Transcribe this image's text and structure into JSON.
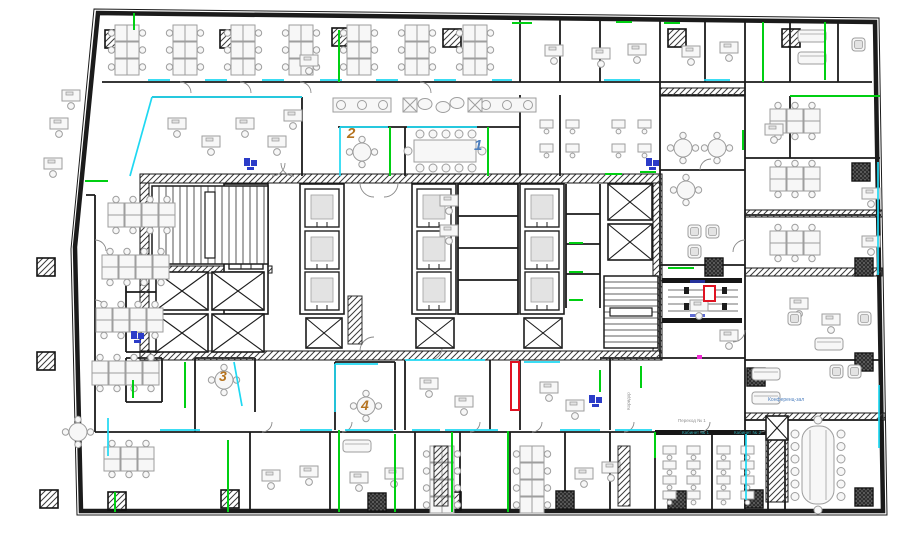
{
  "labels": {
    "room1": "1",
    "room2": "2",
    "room3": "3",
    "room4": "4",
    "conference": "Конференц-зал",
    "cabinet1": "Кабинет № 1",
    "cabinet2": "Кабинет № 2",
    "walkway": "Переход № 1",
    "corridor": "Коридор"
  },
  "colors": {
    "wall": "#1b1b1b",
    "fur": "#9e9e9e",
    "accent_cyan": "#1fd8f2",
    "accent_green": "#00cf12",
    "accent_red": "#e01322",
    "accent_blue": "#2b3cc8",
    "accent_magenta": "#f02bd4",
    "label_orange": "#b5731f",
    "label_blue": "#4d7fbe",
    "label_teal": "#2fa0a8",
    "label_gray": "#8f8f8f"
  },
  "overlays": {
    "cyan_segments": [
      [
        148,
        80,
        170,
        80
      ],
      [
        205,
        80,
        227,
        80
      ],
      [
        262,
        80,
        284,
        80
      ],
      [
        320,
        80,
        342,
        80
      ],
      [
        376,
        80,
        398,
        80
      ],
      [
        434,
        80,
        456,
        80
      ],
      [
        492,
        80,
        512,
        80
      ],
      [
        604,
        80,
        640,
        80
      ],
      [
        704,
        80,
        730,
        80
      ],
      [
        152,
        97,
        302,
        97
      ],
      [
        152,
        97,
        130,
        176
      ],
      [
        340,
        127,
        388,
        127
      ],
      [
        407,
        127,
        477,
        127
      ],
      [
        340,
        127,
        340,
        176
      ],
      [
        234,
        362,
        242,
        406
      ],
      [
        335,
        364,
        378,
        364
      ],
      [
        335,
        364,
        335,
        412
      ],
      [
        108,
        418,
        108,
        456
      ],
      [
        160,
        430,
        200,
        430
      ],
      [
        300,
        430,
        332,
        430
      ],
      [
        345,
        430,
        393,
        430
      ],
      [
        412,
        430,
        440,
        430
      ],
      [
        445,
        430,
        498,
        430
      ],
      [
        560,
        430,
        600,
        430
      ],
      [
        615,
        430,
        652,
        430
      ],
      [
        878,
        162,
        878,
        275
      ],
      [
        879,
        385,
        879,
        448
      ],
      [
        746,
        434,
        746,
        500
      ],
      [
        405,
        360,
        485,
        360
      ],
      [
        524,
        362,
        560,
        362
      ]
    ],
    "green_segments": [
      [
        134,
        13,
        134,
        30
      ],
      [
        339,
        30,
        339,
        82
      ],
      [
        512,
        23,
        532,
        23
      ],
      [
        616,
        22,
        632,
        22
      ],
      [
        664,
        23,
        680,
        23
      ],
      [
        763,
        22,
        763,
        82
      ],
      [
        825,
        22,
        825,
        80
      ],
      [
        790,
        96,
        880,
        96
      ],
      [
        743,
        130,
        743,
        150
      ],
      [
        85,
        181,
        108,
        181
      ],
      [
        390,
        127,
        390,
        176
      ],
      [
        488,
        127,
        488,
        176
      ],
      [
        605,
        174,
        622,
        174
      ],
      [
        640,
        172,
        656,
        172
      ],
      [
        569,
        243,
        583,
        243
      ],
      [
        569,
        272,
        583,
        272
      ],
      [
        569,
        300,
        583,
        300
      ],
      [
        668,
        268,
        694,
        268
      ],
      [
        641,
        366,
        641,
        388
      ],
      [
        600,
        370,
        600,
        392
      ],
      [
        133,
        380,
        133,
        398
      ],
      [
        185,
        362,
        185,
        408
      ],
      [
        339,
        430,
        339,
        512
      ],
      [
        395,
        434,
        395,
        512
      ],
      [
        452,
        432,
        452,
        512
      ],
      [
        508,
        431,
        508,
        512
      ],
      [
        228,
        440,
        228,
        512
      ],
      [
        115,
        492,
        115,
        512
      ],
      [
        655,
        432,
        655,
        458
      ]
    ],
    "red_gate_box": [
      704,
      286,
      11,
      15
    ],
    "red_wall_segment": [
      511,
      362,
      8,
      48
    ],
    "magenta_dot": [
      697,
      355,
      5,
      4
    ],
    "blue_equipment": [
      [
        244,
        158
      ],
      [
        646,
        158
      ],
      [
        131,
        331
      ],
      [
        589,
        395
      ]
    ]
  },
  "furniture": {
    "columns_hatched": [
      [
        105,
        30
      ],
      [
        220,
        30
      ],
      [
        332,
        28
      ],
      [
        443,
        29
      ],
      [
        668,
        29
      ],
      [
        782,
        29
      ],
      [
        37,
        258
      ],
      [
        37,
        352
      ],
      [
        40,
        490
      ],
      [
        108,
        492
      ],
      [
        221,
        490
      ],
      [
        443,
        492
      ]
    ],
    "columns_dark": [
      [
        368,
        493
      ],
      [
        556,
        491
      ],
      [
        668,
        491
      ],
      [
        855,
        488
      ],
      [
        852,
        163
      ],
      [
        855,
        258
      ],
      [
        705,
        258
      ],
      [
        855,
        353
      ],
      [
        747,
        368
      ],
      [
        745,
        490
      ]
    ],
    "bench_clusters_v": [
      {
        "x": 110,
        "y": 25,
        "rows": 3
      },
      {
        "x": 168,
        "y": 25,
        "rows": 3
      },
      {
        "x": 226,
        "y": 25,
        "rows": 3
      },
      {
        "x": 284,
        "y": 25,
        "rows": 3
      },
      {
        "x": 342,
        "y": 25,
        "rows": 3
      },
      {
        "x": 400,
        "y": 25,
        "rows": 3
      },
      {
        "x": 458,
        "y": 25,
        "rows": 3
      },
      {
        "x": 425,
        "y": 446,
        "rows": 4
      },
      {
        "x": 515,
        "y": 446,
        "rows": 4
      }
    ],
    "bench_rows_h": [
      {
        "x": 108,
        "y": 198,
        "cols": 4
      },
      {
        "x": 102,
        "y": 250,
        "cols": 4
      },
      {
        "x": 96,
        "y": 303,
        "cols": 4
      },
      {
        "x": 92,
        "y": 356,
        "cols": 4
      },
      {
        "x": 104,
        "y": 442,
        "cols": 3
      },
      {
        "x": 770,
        "y": 104,
        "cols": 3
      },
      {
        "x": 770,
        "y": 162,
        "cols": 3
      },
      {
        "x": 770,
        "y": 226,
        "cols": 3
      }
    ],
    "desk_grids": [
      {
        "x": 663,
        "y": 446,
        "rows": 4,
        "cols": 2,
        "dx": 24,
        "dy": 15
      },
      {
        "x": 717,
        "y": 446,
        "rows": 4,
        "cols": 2,
        "dx": 24,
        "dy": 15
      },
      {
        "x": 540,
        "y": 120,
        "rows": 2,
        "cols": 2,
        "dx": 26,
        "dy": 24
      },
      {
        "x": 612,
        "y": 120,
        "rows": 2,
        "cols": 2,
        "dx": 26,
        "dy": 24
      }
    ],
    "single_desks": [
      [
        50,
        118
      ],
      [
        44,
        158
      ],
      [
        62,
        90
      ],
      [
        300,
        55
      ],
      [
        545,
        45
      ],
      [
        592,
        48
      ],
      [
        628,
        44
      ],
      [
        682,
        46
      ],
      [
        720,
        42
      ],
      [
        168,
        118
      ],
      [
        202,
        136
      ],
      [
        236,
        118
      ],
      [
        268,
        136
      ],
      [
        284,
        110
      ],
      [
        440,
        195
      ],
      [
        440,
        225
      ],
      [
        690,
        300
      ],
      [
        720,
        330
      ],
      [
        262,
        470
      ],
      [
        300,
        466
      ],
      [
        350,
        472
      ],
      [
        385,
        468
      ],
      [
        575,
        468
      ],
      [
        602,
        462
      ],
      [
        420,
        378
      ],
      [
        455,
        396
      ],
      [
        540,
        382
      ],
      [
        566,
        400
      ],
      [
        790,
        298
      ],
      [
        822,
        314
      ],
      [
        765,
        124
      ],
      [
        862,
        188
      ],
      [
        862,
        236
      ]
    ],
    "round_tables": [
      [
        362,
        152
      ],
      [
        224,
        380
      ],
      [
        366,
        406
      ],
      [
        683,
        148
      ],
      [
        717,
        148
      ],
      [
        686,
        190
      ],
      [
        78,
        432
      ]
    ],
    "sofas": [
      [
        798,
        30
      ],
      [
        798,
        52
      ],
      [
        752,
        368
      ],
      [
        752,
        392
      ],
      [
        815,
        338
      ],
      [
        343,
        440
      ]
    ],
    "armchairs": [
      [
        852,
        38
      ],
      [
        830,
        365
      ],
      [
        848,
        365
      ],
      [
        788,
        312
      ],
      [
        858,
        312
      ],
      [
        688,
        225
      ],
      [
        706,
        225
      ],
      [
        688,
        245
      ]
    ],
    "lounge_benches": [
      [
        333,
        98
      ],
      [
        478,
        98
      ]
    ],
    "x_tables": [
      [
        403,
        98
      ],
      [
        468,
        98
      ]
    ],
    "blobs": [
      [
        425,
        104
      ],
      [
        443,
        107
      ],
      [
        457,
        103
      ]
    ],
    "elevator_shafts": [
      [
        224,
        184,
        44,
        130
      ],
      [
        300,
        184,
        44,
        130
      ],
      [
        412,
        184,
        44,
        130
      ],
      [
        520,
        184,
        44,
        130
      ]
    ],
    "elevator_cars": [
      [
        229,
        189
      ],
      [
        229,
        231
      ],
      [
        229,
        272
      ],
      [
        305,
        189
      ],
      [
        305,
        231
      ],
      [
        305,
        272
      ],
      [
        417,
        189
      ],
      [
        417,
        231
      ],
      [
        417,
        272
      ],
      [
        525,
        189
      ],
      [
        525,
        231
      ],
      [
        525,
        272
      ]
    ],
    "x_shafts": [
      [
        156,
        272,
        52,
        38
      ],
      [
        212,
        272,
        52,
        38
      ],
      [
        156,
        314,
        52,
        38
      ],
      [
        212,
        314,
        52,
        38
      ],
      [
        306,
        318,
        36,
        30
      ],
      [
        416,
        318,
        38,
        30
      ],
      [
        524,
        318,
        38,
        30
      ],
      [
        608,
        184,
        44,
        36
      ],
      [
        608,
        224,
        44,
        36
      ],
      [
        766,
        416,
        22,
        24
      ]
    ],
    "stairs": [
      {
        "x": 152,
        "y": 186,
        "w": 116,
        "h": 78,
        "step": 7,
        "dir": "v"
      },
      {
        "x": 604,
        "y": 276,
        "w": 54,
        "h": 72,
        "step": 6,
        "dir": "h"
      }
    ],
    "racks": [
      [
        434,
        446,
        14,
        60
      ],
      [
        618,
        446,
        12,
        60
      ],
      [
        348,
        296,
        14,
        48
      ]
    ]
  }
}
